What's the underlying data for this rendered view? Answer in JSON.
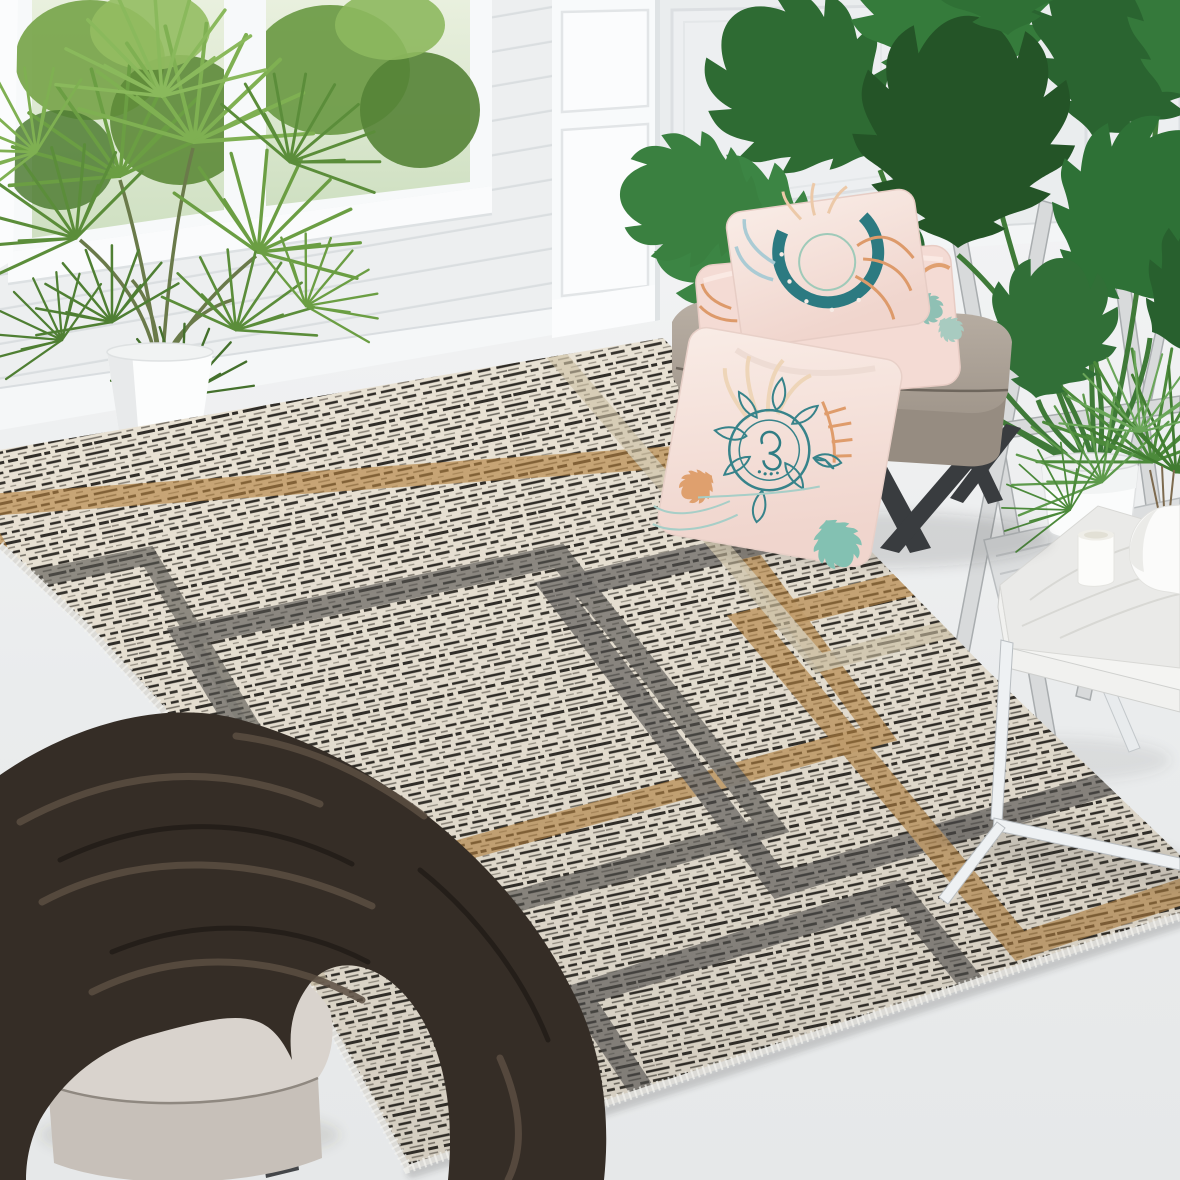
{
  "scene": {
    "description": "Interior product photo of a cream striped area rug with overlapping geometric square outlines in dark gray, camel brown and light beige, styled in a bright white room",
    "type": "product-photograph",
    "text_content": "none"
  },
  "palette": {
    "wall": "#f3f4f5",
    "shiplap_line": "#dadee0",
    "floor": "#e9ebec",
    "rug_cream": "#ebe4d6",
    "rug_stria_dark": "#2f2c27",
    "rug_gray_band": "#565551",
    "rug_camel_band": "#b5823f",
    "rug_beige_band": "#cfc3a6",
    "window_greenery": "#6f9c49",
    "palm_green": "#6b9e43",
    "monstera_green": "#2e6b33",
    "ottoman_taupe": "#a99e93",
    "pillow_pink": "#f5ddd5",
    "print_teal": "#2e7d84",
    "print_orange": "#dd9a6a",
    "blanket_brown": "#352d26",
    "stool_cushion": "#d9d3cd",
    "whitewash_wood": "#d8dadb",
    "metal_dark": "#45474a",
    "marble_top": "#eaeae8",
    "chrome_leg": "#eef1f3"
  },
  "objects": {
    "room": {
      "label": "white room with shiplap wall, paneled wall and windows"
    },
    "window": {
      "label": "window with green trees outside"
    },
    "palm_plant": {
      "label": "potted fan palm in white planter"
    },
    "monstera_plant": {
      "label": "potted monstera in white planter"
    },
    "folding_stool": {
      "label": "whitewashed folding plant stand"
    },
    "rug": {
      "label": "cream striped rug with gray, camel and beige overlapping square outlines"
    },
    "ottoman": {
      "label": "taupe ottoman bench with dark metal legs"
    },
    "pillows": {
      "label": "two stacked blush pillows with teal moon and botanical print"
    },
    "mandala_pillow": {
      "label": "blush pillow with teal mandala print leaning against ottoman"
    },
    "side_table": {
      "label": "marble-top side table with chrome frame"
    },
    "candle": {
      "label": "white candle"
    },
    "vase": {
      "label": "white vase with areca fronds"
    },
    "bench_stool": {
      "label": "beige cushioned stool with dark legs"
    },
    "blanket": {
      "label": "dark brown fleece blanket draped over stool"
    }
  }
}
